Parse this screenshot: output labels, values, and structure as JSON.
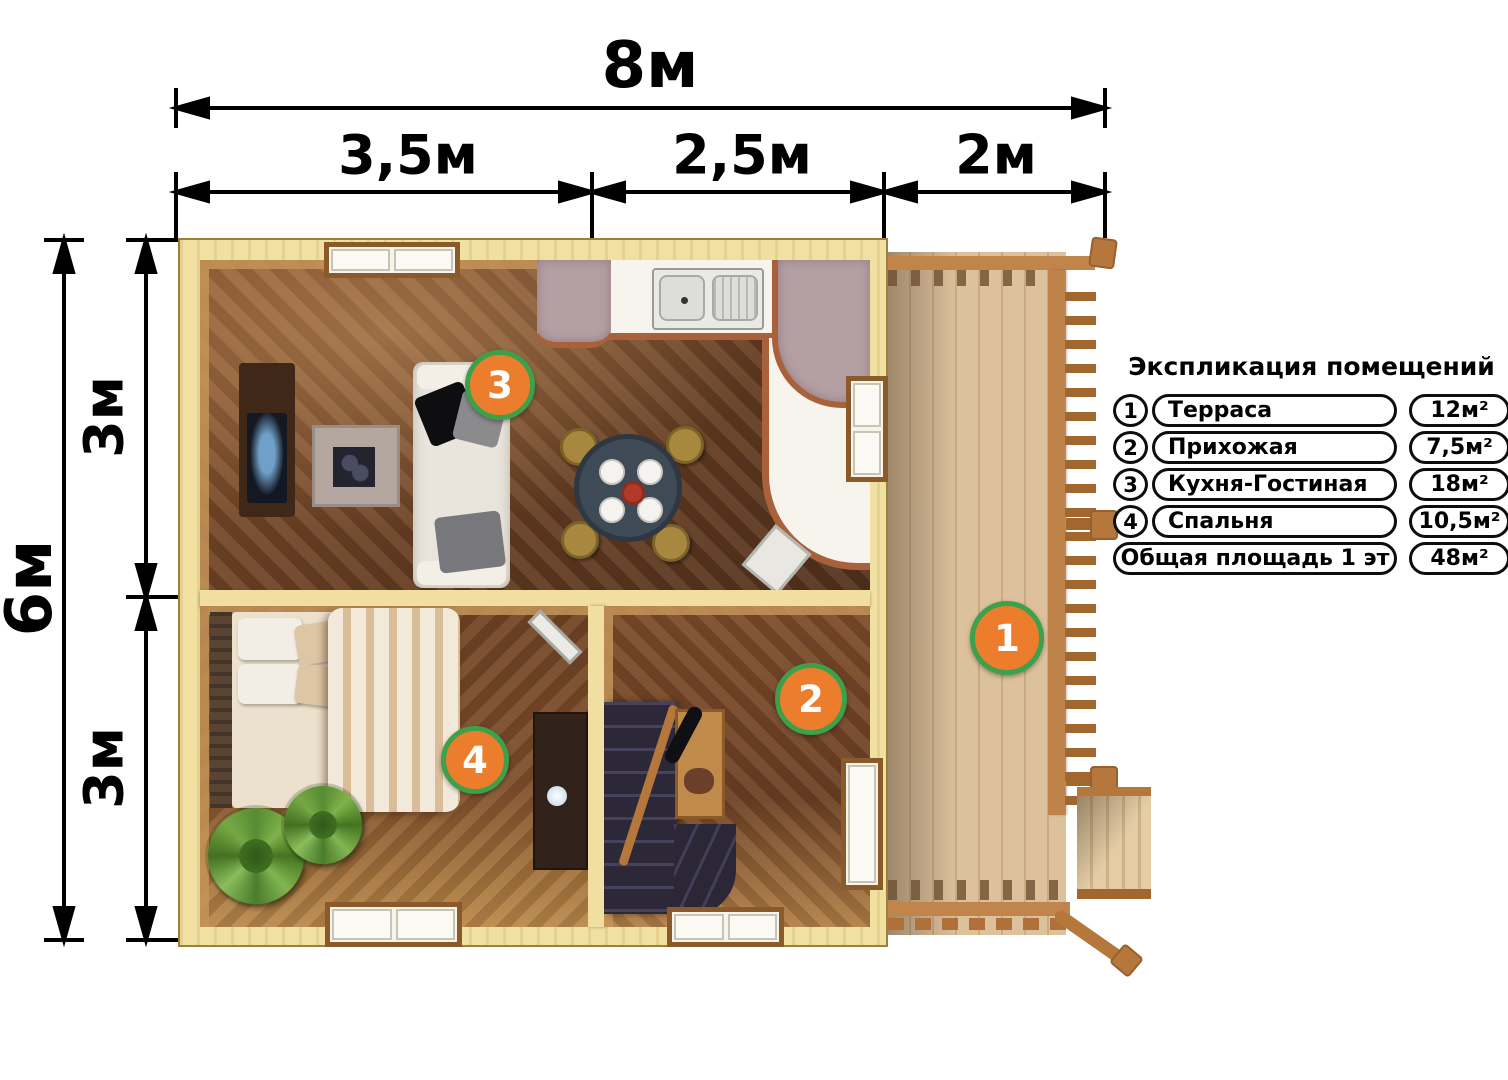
{
  "dimensions": {
    "width_total": "8м",
    "width_segments": [
      "3,5м",
      "2,5м",
      "2м"
    ],
    "height_total": "6м",
    "height_segments": [
      "3м",
      "3м"
    ]
  },
  "markers": {
    "terrace": "1",
    "hallway": "2",
    "kitchen_living": "3",
    "bedroom": "4"
  },
  "legend": {
    "title": "Экспликация помещений",
    "rows": [
      {
        "num": "1",
        "name": "Терраса",
        "area": "12м²"
      },
      {
        "num": "2",
        "name": "Прихожая",
        "area": "7,5м²"
      },
      {
        "num": "3",
        "name": "Кухня-Гостиная",
        "area": "18м²"
      },
      {
        "num": "4",
        "name": "Спальня",
        "area": "10,5м²"
      }
    ],
    "total": {
      "name": "Общая площадь 1 эт",
      "area": "48м²"
    }
  },
  "colors": {
    "marker_fill": "#ec7d2c",
    "marker_border": "#3da04a",
    "wall": "#f0e0a2",
    "deck": "#dcc19c",
    "dimension": "#000000"
  }
}
